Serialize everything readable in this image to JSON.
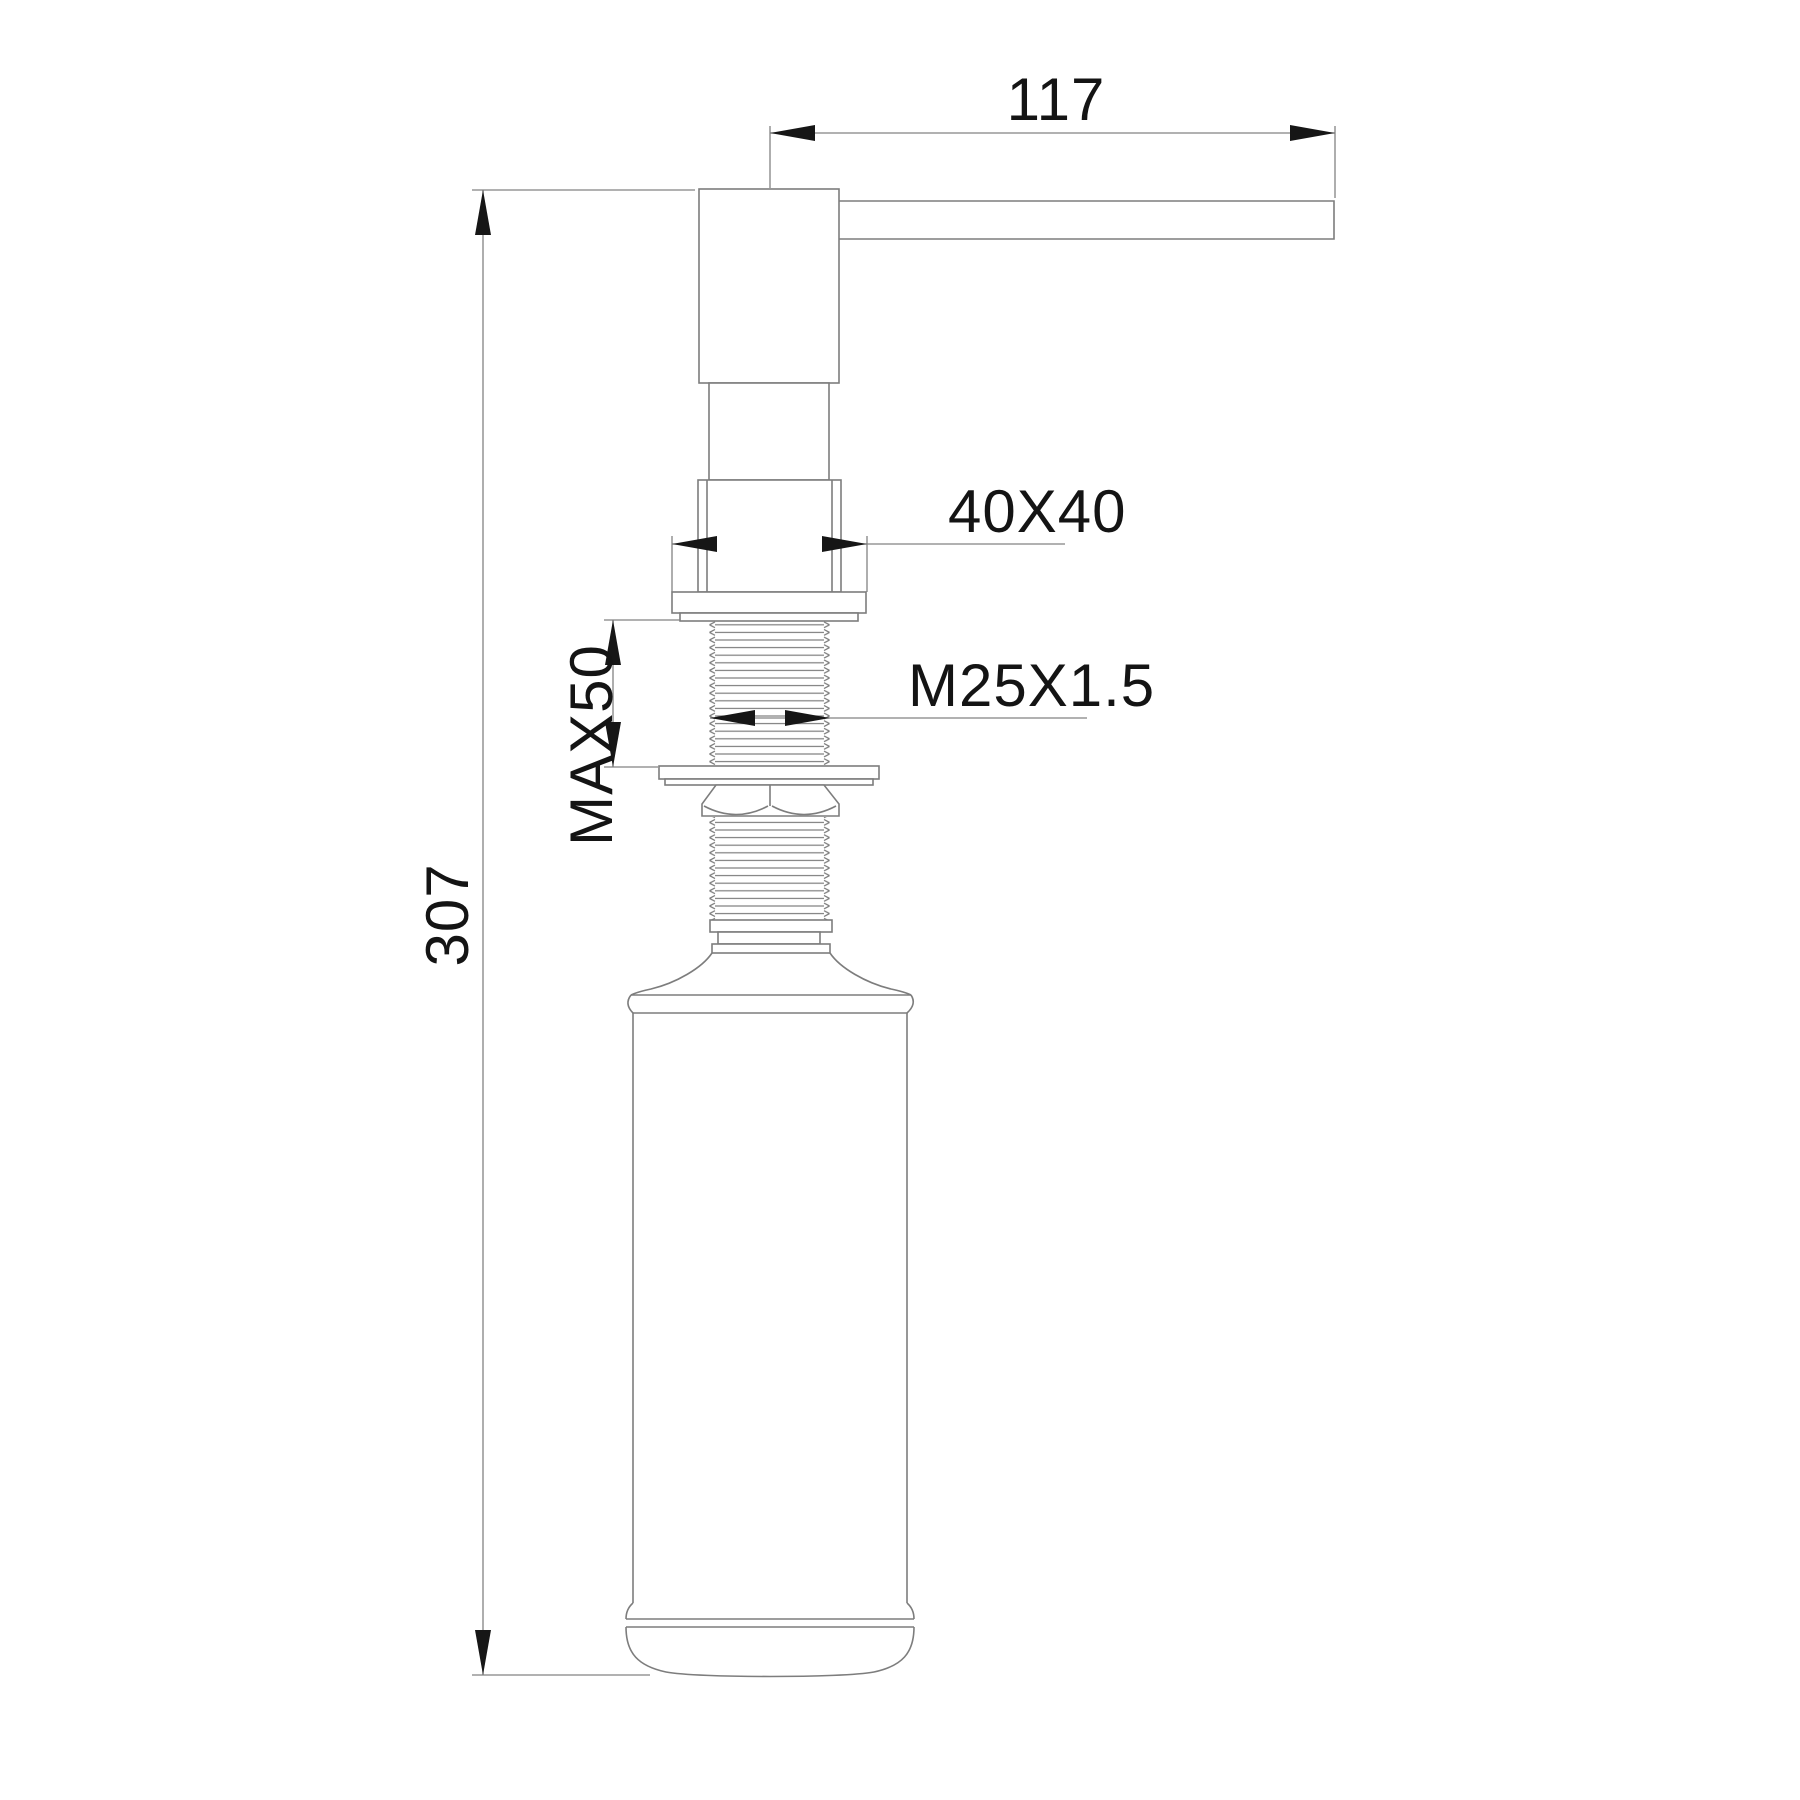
{
  "labels": {
    "spout_length": "117",
    "head_section": "40X40",
    "max_thickness": "MAX50",
    "thread_spec": "M25X1.5",
    "overall_height": "307"
  },
  "colors": {
    "background": "#ffffff",
    "outline_line": "#7d7d7d",
    "dimension_line": "#828282",
    "arrow": "#161616",
    "text": "#141414"
  }
}
